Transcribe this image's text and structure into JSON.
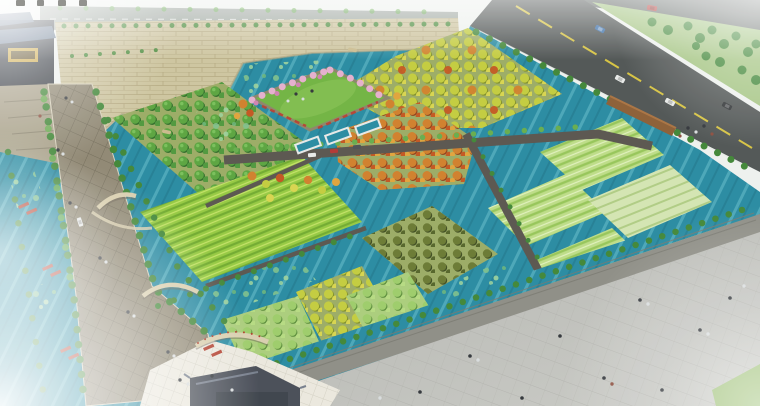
{
  "scene": {
    "type": "aerial-landscape-rendering",
    "regions": [
      "city-wall-with-shrubs",
      "gate-tower",
      "distant-road",
      "urban-road-with-cars",
      "green-slope",
      "moat-pond-with-lilies",
      "tree-lined-promenade",
      "canals-with-rafts",
      "orchard-plots",
      "crop-fields",
      "central-lawn-plaza-with-cherry-trees",
      "reflecting-pools",
      "arch-bridges",
      "embankment-wall",
      "esplanade-with-people",
      "south-gate-roof",
      "white-paved-plaza",
      "corner-lawn"
    ]
  },
  "objects": {
    "cars_main_road": [
      "blue",
      "white",
      "white",
      "black"
    ],
    "car_far_road": "red",
    "cars_access_path": [
      "white",
      "red",
      "dark"
    ],
    "car_promenade": "white",
    "red_rafts": 8,
    "row_boats": 2,
    "arch_bridges": 3,
    "watermark_glyph_count": 4
  },
  "watermark": {
    "glyph_count": 4,
    "cropped_at_top_edge": true
  },
  "colors": {
    "white": "#ffffff",
    "haze": "#eef1ee",
    "waterBase": "#2589a0",
    "waterStreakLight": "#62bcc9",
    "waterStreakDark": "#1b7083",
    "lily1": "#7cc08a",
    "lily2": "#9bd29b",
    "lily3": "#6ab578",
    "wallTan": "#cdc49e",
    "wallLine": "#ab9f76",
    "roadMain": "#4e5352",
    "roadFar": "#96a098",
    "roadTopRight": "#5f6663",
    "yellowLine": "#d6c23e",
    "laneWhite": "#e6e9e6",
    "slopeGreen": "#a3c480",
    "brownWall": "#8a5c32",
    "brownWallTop": "#a8713f",
    "promenade": "#8e8671",
    "promenadeLine": "#6e6754",
    "slopePave": "#a79f87",
    "plazaWhite": "#ebe8dd",
    "plazaGrid": "#d3d0c3",
    "esplanade1": "#b2b3ae",
    "esplanade2": "#c9cac5",
    "espLine": "#a3a49e",
    "embankment": "#8c8c84",
    "embLine": "#75766d",
    "lawn": "#6fb23f",
    "lawnLight": "#83c150",
    "lawnBR": "#9bbf72",
    "fieldBase": "#93c83e",
    "fieldRowDark": "#6fa92c",
    "fieldRowLight": "#c9e468",
    "cropBase": "#bcdc85",
    "cropRowDark": "#94c456",
    "cropRowLight": "#dff0bb",
    "paleBase": "#d3e4b0",
    "paleRow": "#aecb82",
    "orchGround": "#9aaa62",
    "lightGround": "#a9cc79",
    "treeGreen1": "#58a33c",
    "treeGreen2": "#4c963a",
    "treeGreenShadow": "#2e6b26",
    "treeGreenHi": "#7cc45c",
    "treeYellow1": "#c2cb3b",
    "treeYellow2": "#d7d44b",
    "treeYellowShadow": "#7f8f24",
    "treeOrange1": "#d07d28",
    "treeOrange2": "#c2541d",
    "treeOrange3": "#e0a238",
    "treeOrangeShadow": "#8f3f16",
    "treeOlive1": "#68772f",
    "treeOlive2": "#526226",
    "treeOliveShadow": "#3c4a1e",
    "treeLight1": "#9ccb68",
    "treeLight2": "#b5da7f",
    "treeLightShadow": "#5c8f3a",
    "treeRow": "#3e8534",
    "treeRowLight": "#64ab4a",
    "shrub": "#4a8a3a",
    "pink1": "#e4aecb",
    "pink2": "#cf7fae",
    "flowerRed": "#b8392a",
    "raftRed": "#b03a28",
    "boatTan": "#c9b98a",
    "bridgeTan": "#d8cead",
    "bridgeShadow": "#6b6456",
    "gateRoof": "#454a54",
    "gateRoofHi": "#747c8a",
    "gateRoofDark": "#3a4048",
    "tlBody": "#32373e",
    "tlRoof": "#5c7089",
    "tlGold": "#caa53e",
    "carBlue": "#3a6ea8",
    "carWhite": "#e8eae8",
    "carBlack": "#2b2e30",
    "carRed": "#b03430",
    "carDark": "#4a4e52",
    "peopleDark": "#2e3237",
    "peopleLight": "#d8dcdd",
    "peopleRed": "#8a4a3a",
    "pathDark": "#57534b",
    "watermarkInk": "#3f3f38"
  }
}
